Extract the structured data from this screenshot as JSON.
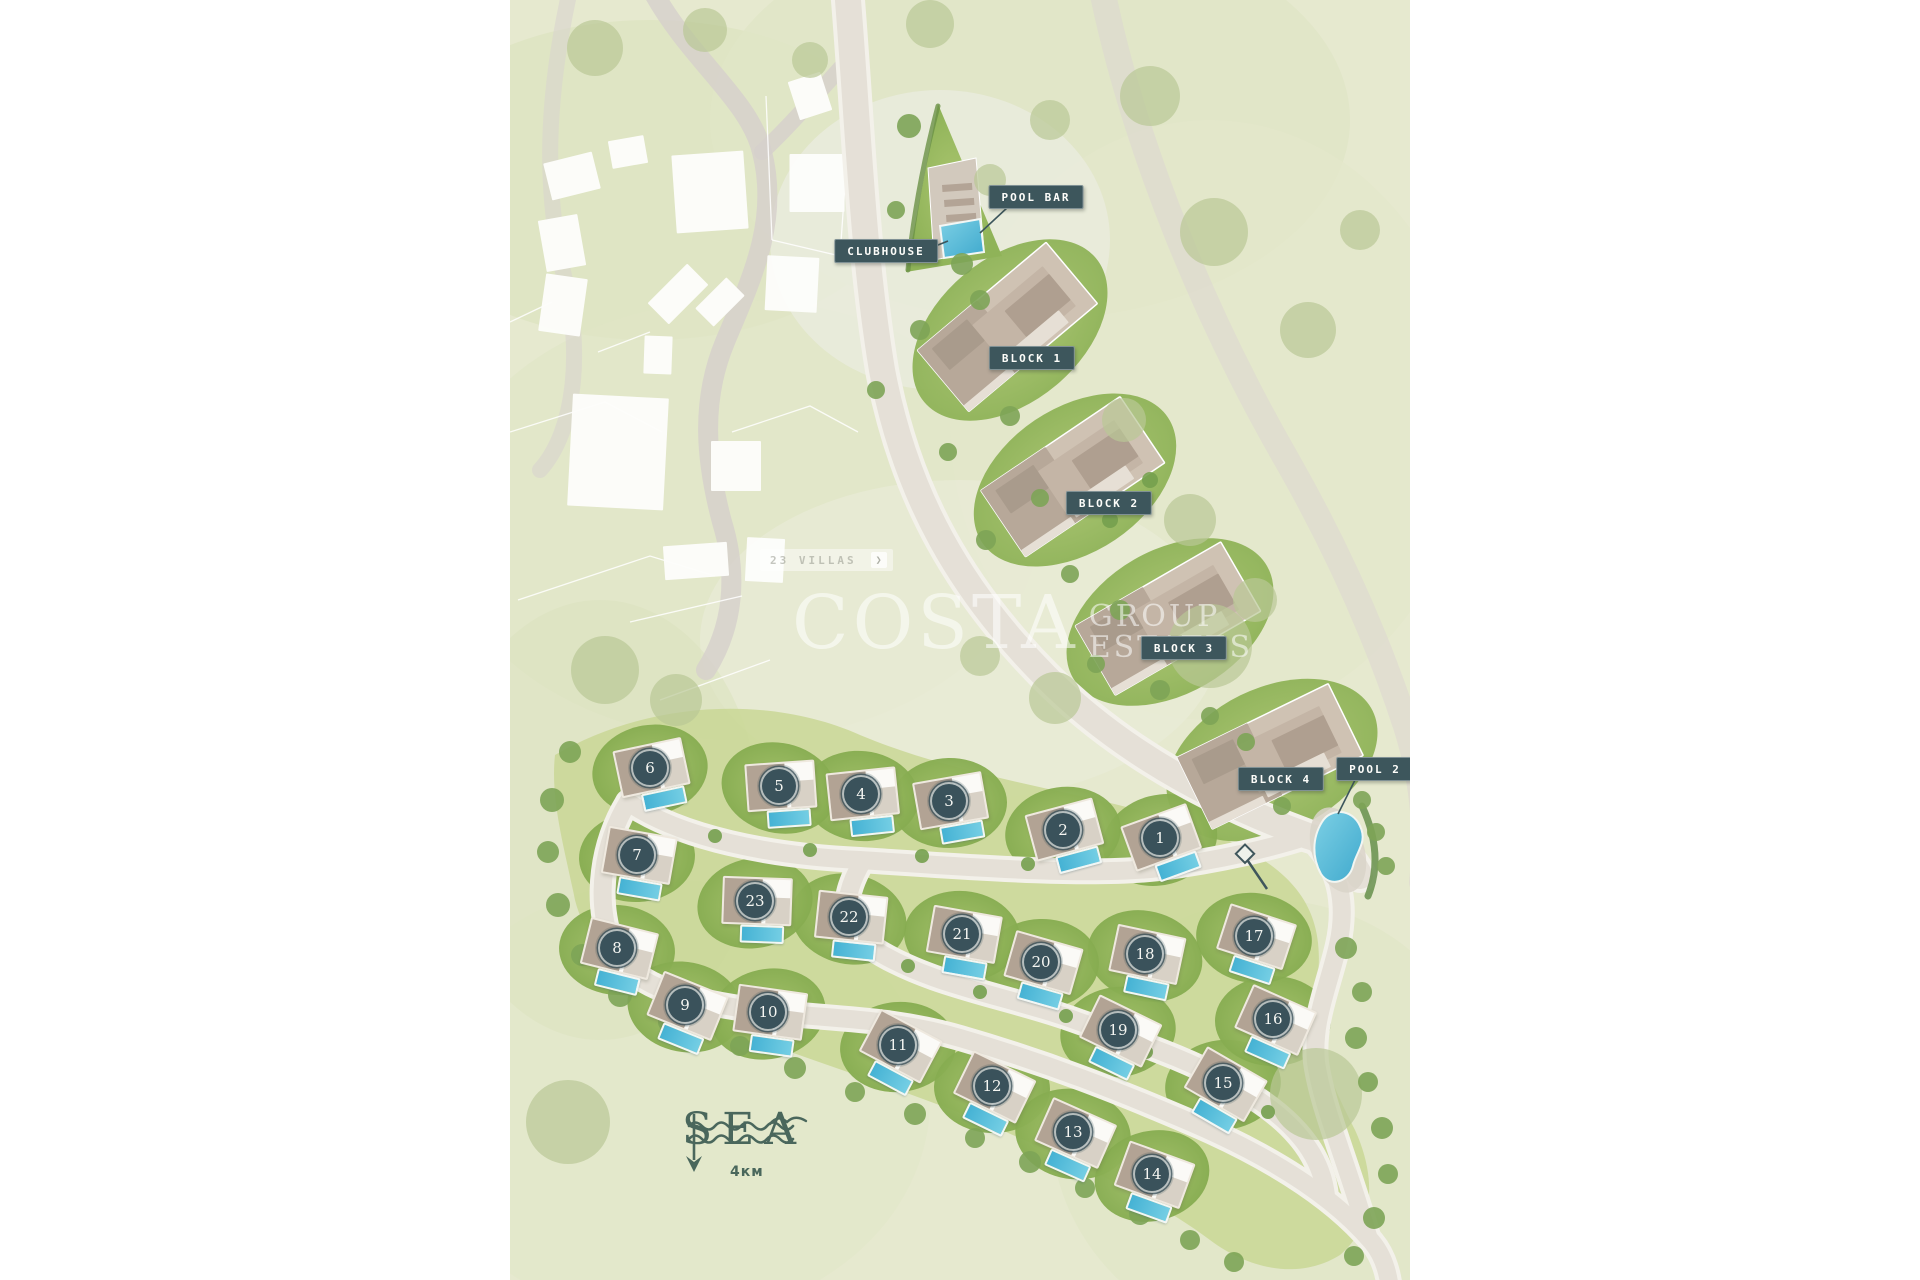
{
  "watermark": {
    "word1": "COSTA",
    "word2": "GROUP",
    "word3": "ESTATES"
  },
  "amenities": [
    {
      "id": "clubhouse",
      "label": "CLUBHOUSE",
      "x": 376,
      "y": 251
    },
    {
      "id": "pool-bar",
      "label": "POOL BAR",
      "x": 526,
      "y": 197
    },
    {
      "id": "block-1",
      "label": "BLOCK 1",
      "x": 522,
      "y": 358
    },
    {
      "id": "block-2",
      "label": "BLOCK 2",
      "x": 599,
      "y": 503
    },
    {
      "id": "block-3",
      "label": "BLOCK 3",
      "x": 674,
      "y": 648
    },
    {
      "id": "block-4",
      "label": "BLOCK 4",
      "x": 771,
      "y": 779
    },
    {
      "id": "pool-2",
      "label": "POOL 2",
      "x": 865,
      "y": 769
    }
  ],
  "villas": [
    {
      "number": "1",
      "x": 650,
      "y": 840
    },
    {
      "number": "2",
      "x": 553,
      "y": 832
    },
    {
      "number": "3",
      "x": 439,
      "y": 803
    },
    {
      "number": "4",
      "x": 351,
      "y": 796
    },
    {
      "number": "5",
      "x": 269,
      "y": 788
    },
    {
      "number": "6",
      "x": 140,
      "y": 770
    },
    {
      "number": "7",
      "x": 127,
      "y": 857
    },
    {
      "number": "8",
      "x": 107,
      "y": 950
    },
    {
      "number": "9",
      "x": 175,
      "y": 1007
    },
    {
      "number": "10",
      "x": 258,
      "y": 1014
    },
    {
      "number": "11",
      "x": 388,
      "y": 1047
    },
    {
      "number": "12",
      "x": 482,
      "y": 1088
    },
    {
      "number": "13",
      "x": 563,
      "y": 1134
    },
    {
      "number": "14",
      "x": 642,
      "y": 1176
    },
    {
      "number": "15",
      "x": 713,
      "y": 1085
    },
    {
      "number": "16",
      "x": 763,
      "y": 1021
    },
    {
      "number": "17",
      "x": 744,
      "y": 938
    },
    {
      "number": "18",
      "x": 635,
      "y": 956
    },
    {
      "number": "19",
      "x": 608,
      "y": 1032
    },
    {
      "number": "20",
      "x": 531,
      "y": 964
    },
    {
      "number": "21",
      "x": 452,
      "y": 936
    },
    {
      "number": "22",
      "x": 339,
      "y": 919
    },
    {
      "number": "23",
      "x": 245,
      "y": 903
    }
  ],
  "direction_sign": {
    "text": "23 VILLAS",
    "chevron": "❯"
  },
  "sea": {
    "label": "SEA",
    "distance": "4км"
  },
  "colors": {
    "label_bg": "#3d565c",
    "badge_bg": "#3a525b",
    "pool": "#5cc3de",
    "lawn": "#9fc063",
    "sea_text": "#4a675c",
    "map_bg": "#e6e9cf"
  }
}
